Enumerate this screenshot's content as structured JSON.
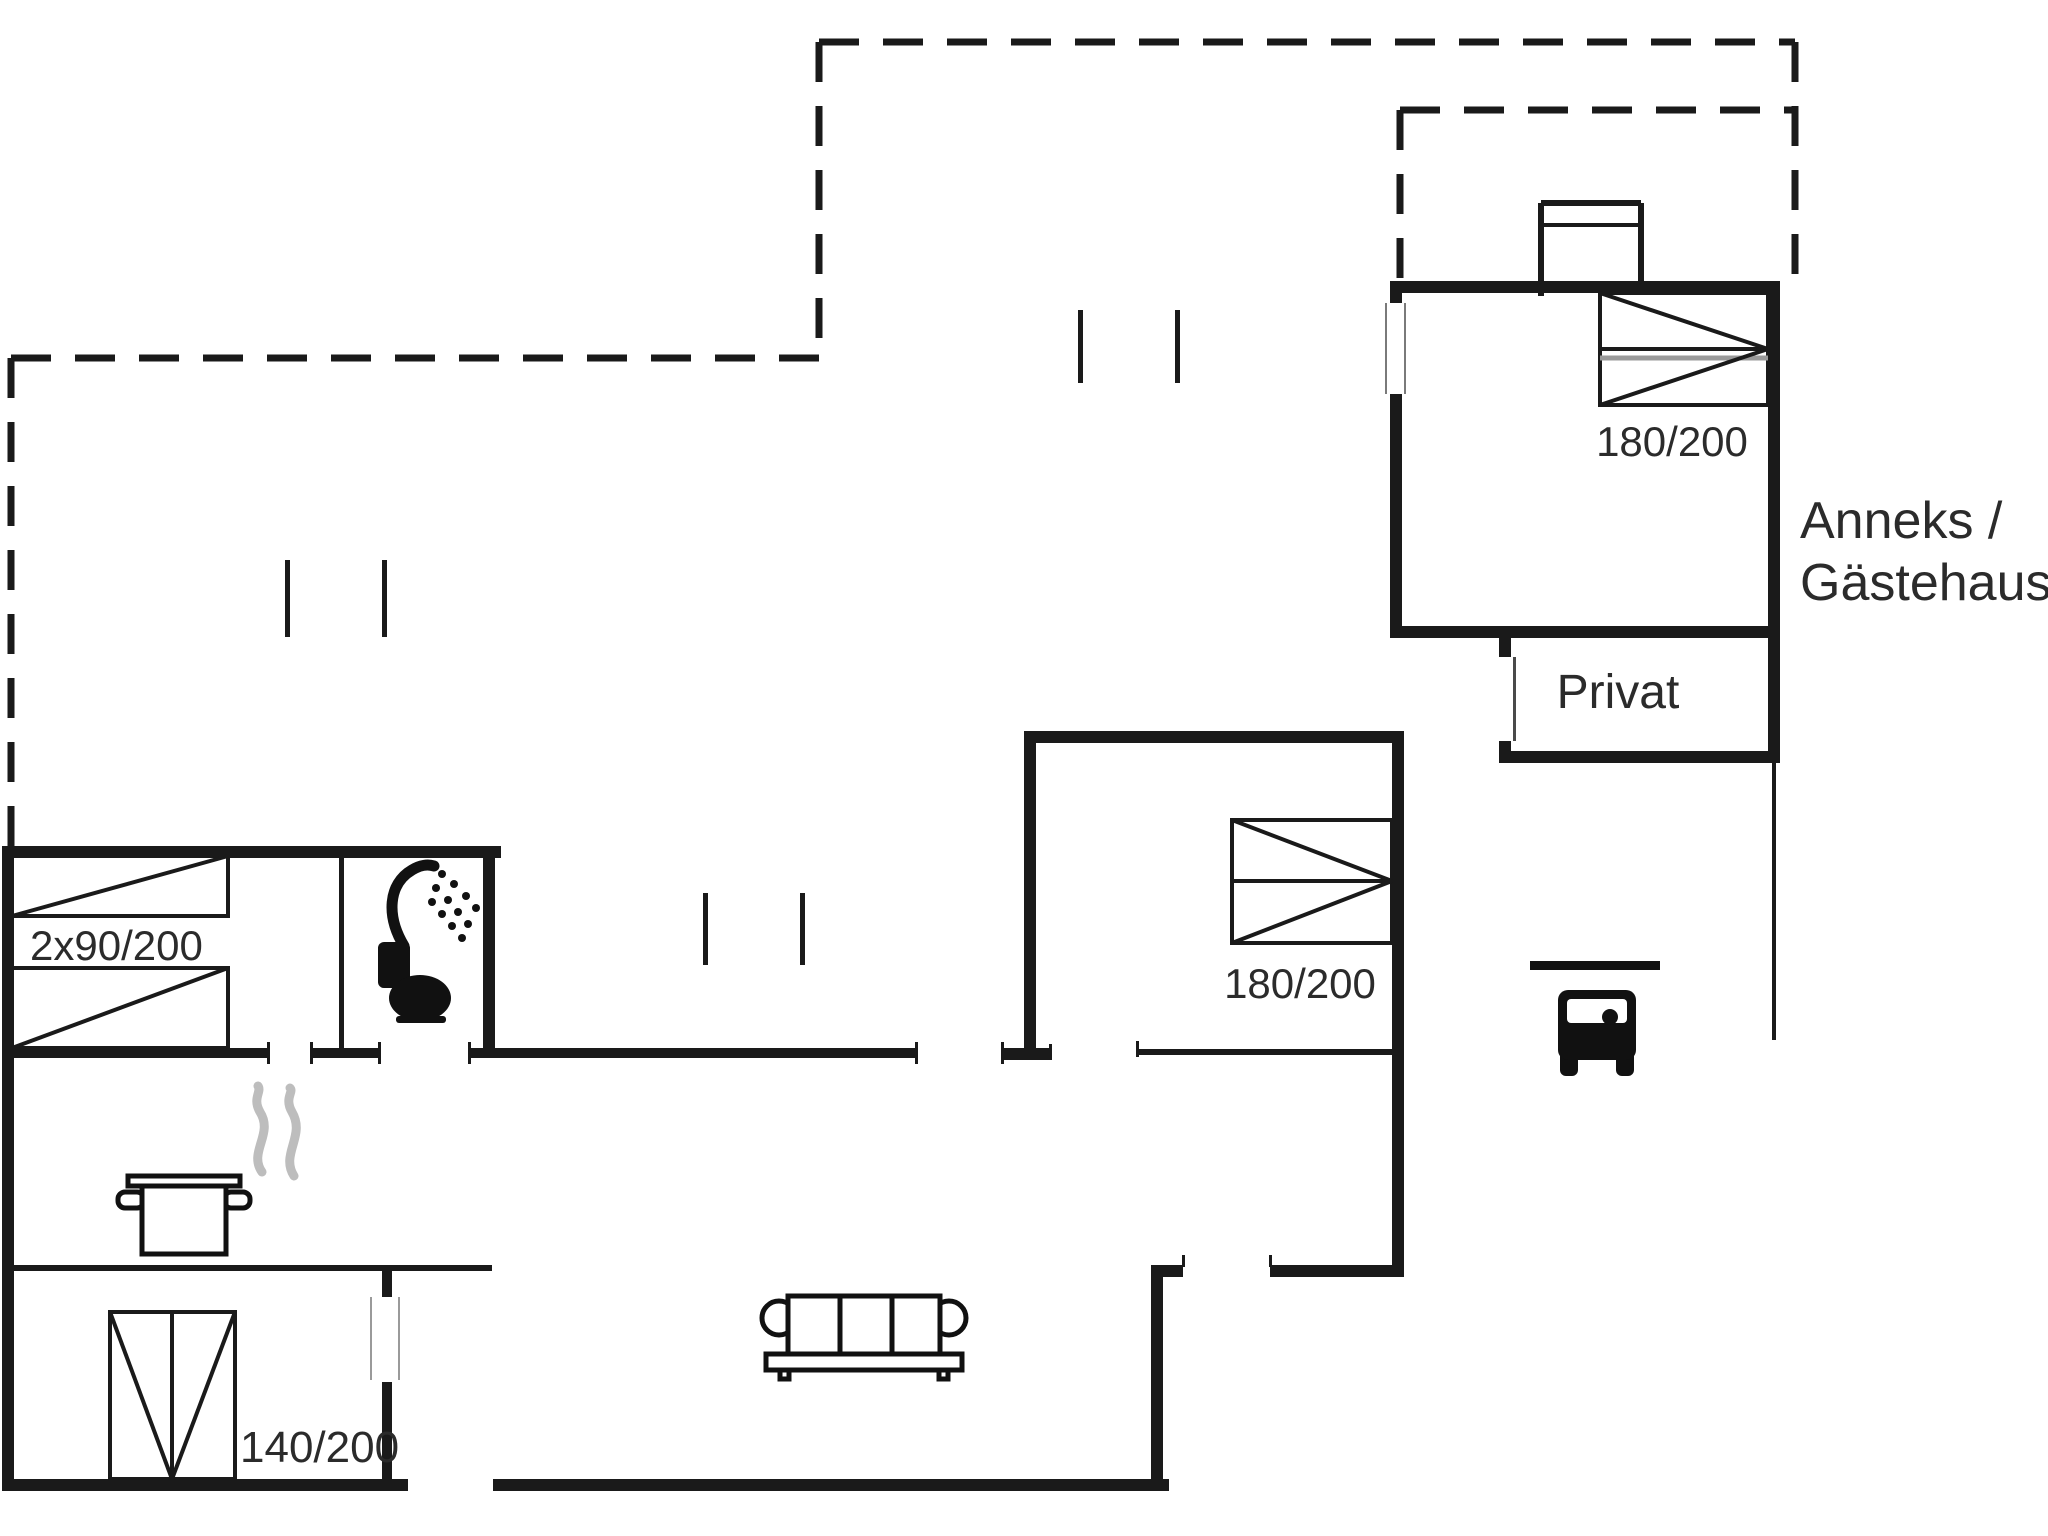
{
  "document": {
    "type": "floor-plan",
    "background": "#ffffff"
  },
  "colors": {
    "wall": "#1a1a1a",
    "label_text": "#2b2b2b",
    "steam_gray": "#bdbdbd",
    "bed_gray_line": "#9a9a9a"
  },
  "labels": {
    "nw_beds": "2x90/200",
    "sw_bed": "140/200",
    "main_bed": "180/200",
    "annex_bed": "180/200",
    "privat_room": "Privat",
    "annex_caption_line1": "Anneks /",
    "annex_caption_line2": "Gästehaus"
  },
  "icons": {
    "shower": "shower-icon",
    "toilet": "toilet-icon",
    "cooking_pot": "cooking-pot-icon",
    "steam": "steam-icon",
    "sofa": "sofa-icon",
    "car": "car-icon",
    "beds": "bed-symbol",
    "entrance_mark": "entrance-mark"
  }
}
